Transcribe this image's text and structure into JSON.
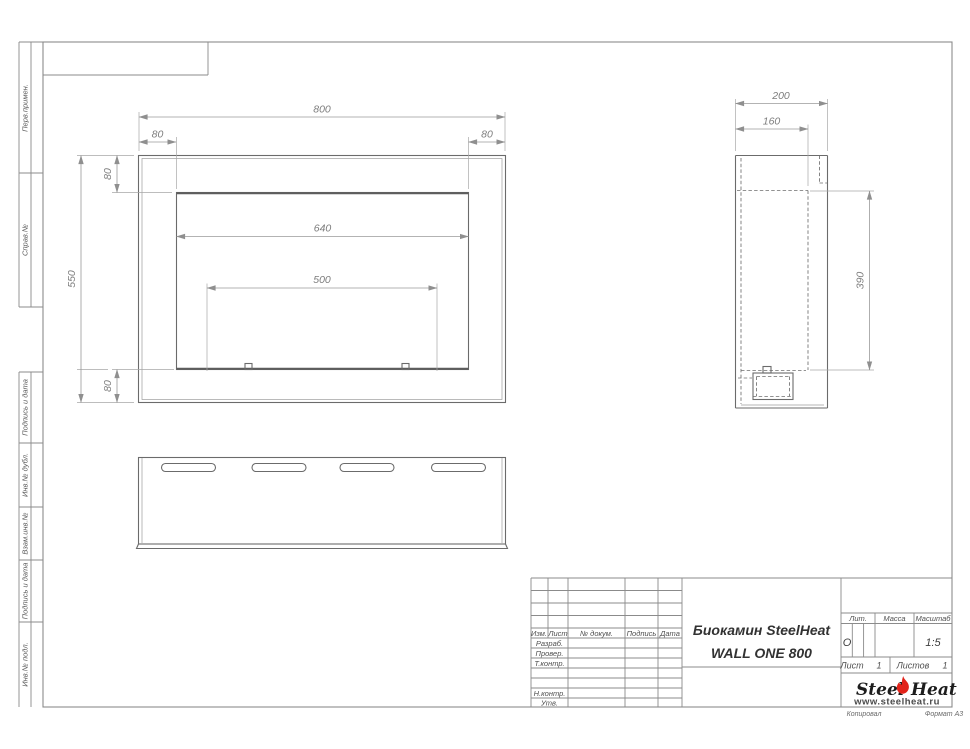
{
  "margin_labels": {
    "perv": "Перв.примен.",
    "sprav": "Справ.№",
    "podpis1": "Подпись и дата",
    "inv_dubl": "Инв.№ дубл.",
    "vzam": "Взам.инв.№",
    "podpis2": "Подпись и дата",
    "inv_podl": "Инв.№ подл."
  },
  "dims": {
    "front_width": "800",
    "front_flange_left": "80",
    "front_flange_right": "80",
    "front_flange_top": "80",
    "front_flange_bottom": "80",
    "front_height": "550",
    "opening_width": "640",
    "burner_width": "500",
    "side_depth": "200",
    "side_inner_depth": "160",
    "side_opening_height": "390"
  },
  "title_block": {
    "product_line1": "Биокамин SteelHeat",
    "product_line2": "WALL ONE 800",
    "col_izm": "Изм.",
    "col_list": "Лист",
    "col_doc": "№ докум.",
    "col_sign": "Подпись",
    "col_date": "Дата",
    "row_razrab": "Разраб.",
    "row_prover": "Провер.",
    "row_tkontr": "Т.контр.",
    "row_nkontr": "Н.контр.",
    "row_utv": "Утв.",
    "lit_label": "Лит.",
    "lit_value": "О",
    "mass_label": "Масса",
    "scale_label": "Масштаб",
    "scale_value": "1:5",
    "sheet_label": "Лист",
    "sheet_value": "1",
    "sheets_label": "Листов",
    "sheets_value": "1"
  },
  "logo": {
    "steel": "Steel",
    "heat": "Heat",
    "site": "www.steelheat.ru",
    "flame_color": "#e2231a"
  },
  "footer": {
    "copied": "Копировал",
    "format": "Формат А3"
  }
}
